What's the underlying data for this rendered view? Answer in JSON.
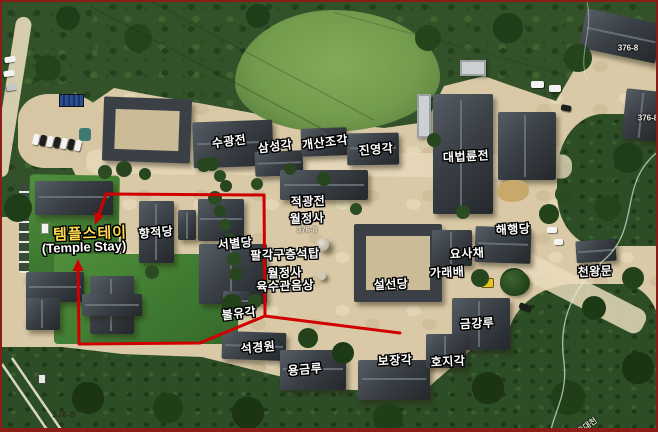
{
  "map_labels": {
    "buildings": [
      {
        "name": "sugwangjeon",
        "text": "수광전"
      },
      {
        "name": "samseonggak",
        "text": "삼성각"
      },
      {
        "name": "gaesanjogak",
        "text": "개산조각"
      },
      {
        "name": "jinyeonggak",
        "text": "진영각"
      },
      {
        "name": "daebeomnyunjeon",
        "text": "대법륜전"
      },
      {
        "name": "jeokgwangjeon",
        "text": "적광전"
      },
      {
        "name": "woljeongsa",
        "text": "월정사"
      },
      {
        "name": "hyangjeokdang",
        "text": "향적당"
      },
      {
        "name": "seobyeoldang",
        "text": "서별당"
      },
      {
        "name": "haehaengdang",
        "text": "해행당"
      },
      {
        "name": "yosachae",
        "text": "요사채"
      },
      {
        "name": "palgakguchungseoktap",
        "text": "팔각구층석탑"
      },
      {
        "name": "garaebae",
        "text": "가래배"
      },
      {
        "name": "cheonwangmun",
        "text": "천왕문"
      },
      {
        "name": "seolseondang",
        "text": "설선당"
      },
      {
        "name": "buryugak",
        "text": "불유각"
      },
      {
        "name": "geumgangnu",
        "text": "금강루"
      },
      {
        "name": "seokgyeongwon",
        "text": "석경원"
      },
      {
        "name": "bojanggak",
        "text": "보장각"
      },
      {
        "name": "hojigak",
        "text": "호지각"
      },
      {
        "name": "yonggeumnu",
        "text": "용금루"
      }
    ],
    "statue": {
      "line1": "월정사",
      "line2": "육수관음상"
    },
    "temple_stay": {
      "korean": "템플스테이",
      "english": "(Temple Stay)"
    },
    "parcels": {
      "top_right_upper": "376-8",
      "top_right_lower": "376-8",
      "center": "376-8",
      "bottom_left": "376-8"
    },
    "stream": "오대천"
  },
  "colors": {
    "route": "#d10000",
    "temple_stay_text": "#ffd84d",
    "label_text": "#ffffff",
    "frame": "#8c1d16"
  }
}
